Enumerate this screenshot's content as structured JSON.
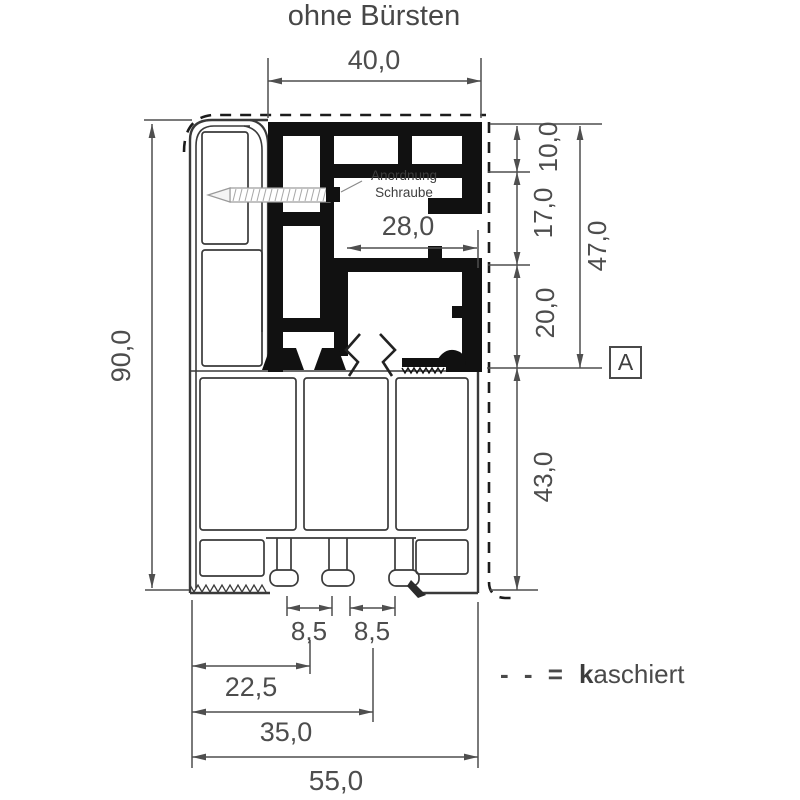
{
  "title": "ohne Bürsten",
  "dimensions": {
    "top_width": "40,0",
    "inner_width": "28,0",
    "total_height": "90,0",
    "seg_top": "10,0",
    "seg_mid": "17,0",
    "seg_low": "20,0",
    "upper_total": "47,0",
    "lower_height": "43,0",
    "slot_left": "8,5",
    "slot_right": "8,5",
    "offset_small": "22,5",
    "offset_large": "35,0",
    "total_width": "55,0"
  },
  "annotations": {
    "screw_note_line1": "Anordnung",
    "screw_note_line2": "Schraube",
    "section_marker": "A"
  },
  "legend": {
    "dash_symbol": "- - =",
    "term_highlight": "k",
    "term_rest": "aschiert"
  },
  "colors": {
    "line": "#4a4a4a",
    "profile_fill": "#111111",
    "dimension_text": "#4d4d4d",
    "background": "#ffffff"
  }
}
